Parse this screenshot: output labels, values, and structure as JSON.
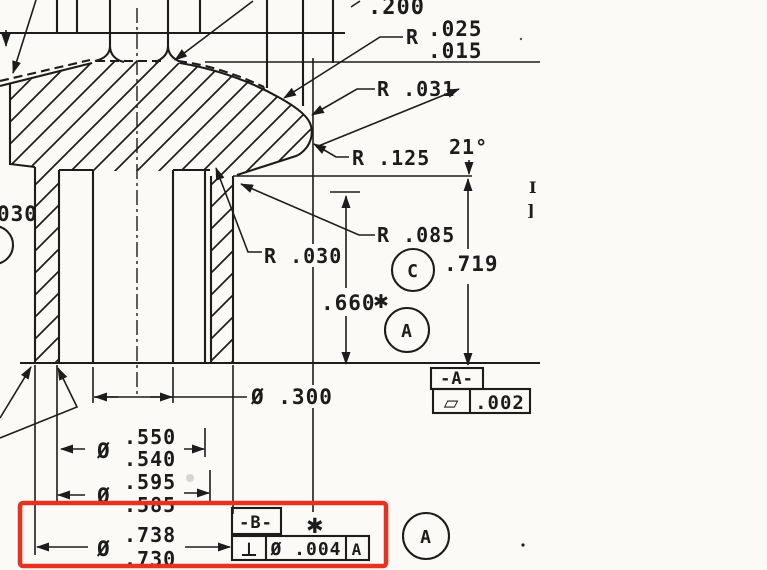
{
  "drawing": {
    "dims": {
      "d200": ".200",
      "r025_letter": "R",
      "r025_upper": ".025",
      "r025_lower": ".015",
      "r031": "R .031",
      "angle": "21°",
      "r125": "R .125",
      "r085": "R .085",
      "r030": "R .030",
      "edge_030": "030",
      "d719": ".719",
      "d660": ".660",
      "dia300": "Ø .300",
      "dia_sym": "Ø",
      "dia550_upper": ".550",
      "dia550_lower": ".540",
      "dia595_upper": ".595",
      "dia595_lower": ".585",
      "dia738_upper": ".738",
      "dia738_lower": ".730"
    },
    "gdt": {
      "datum_a": "-A-",
      "flatness_symbol": "▱",
      "flatness_value": ".002",
      "datum_b": "-B-",
      "perp_symbol": "⊥",
      "perp_value": "Ø .004",
      "perp_datum": "A",
      "balloon_c": "C",
      "balloon_a": "A",
      "asterisk": "✱"
    },
    "marks": {
      "edge_mark_top": "I",
      "edge_mark_bottom": "]"
    },
    "colors": {
      "ink": "#1c1c1c",
      "paper": "#fbfaf6",
      "highlight_red": "#e8321f"
    }
  }
}
